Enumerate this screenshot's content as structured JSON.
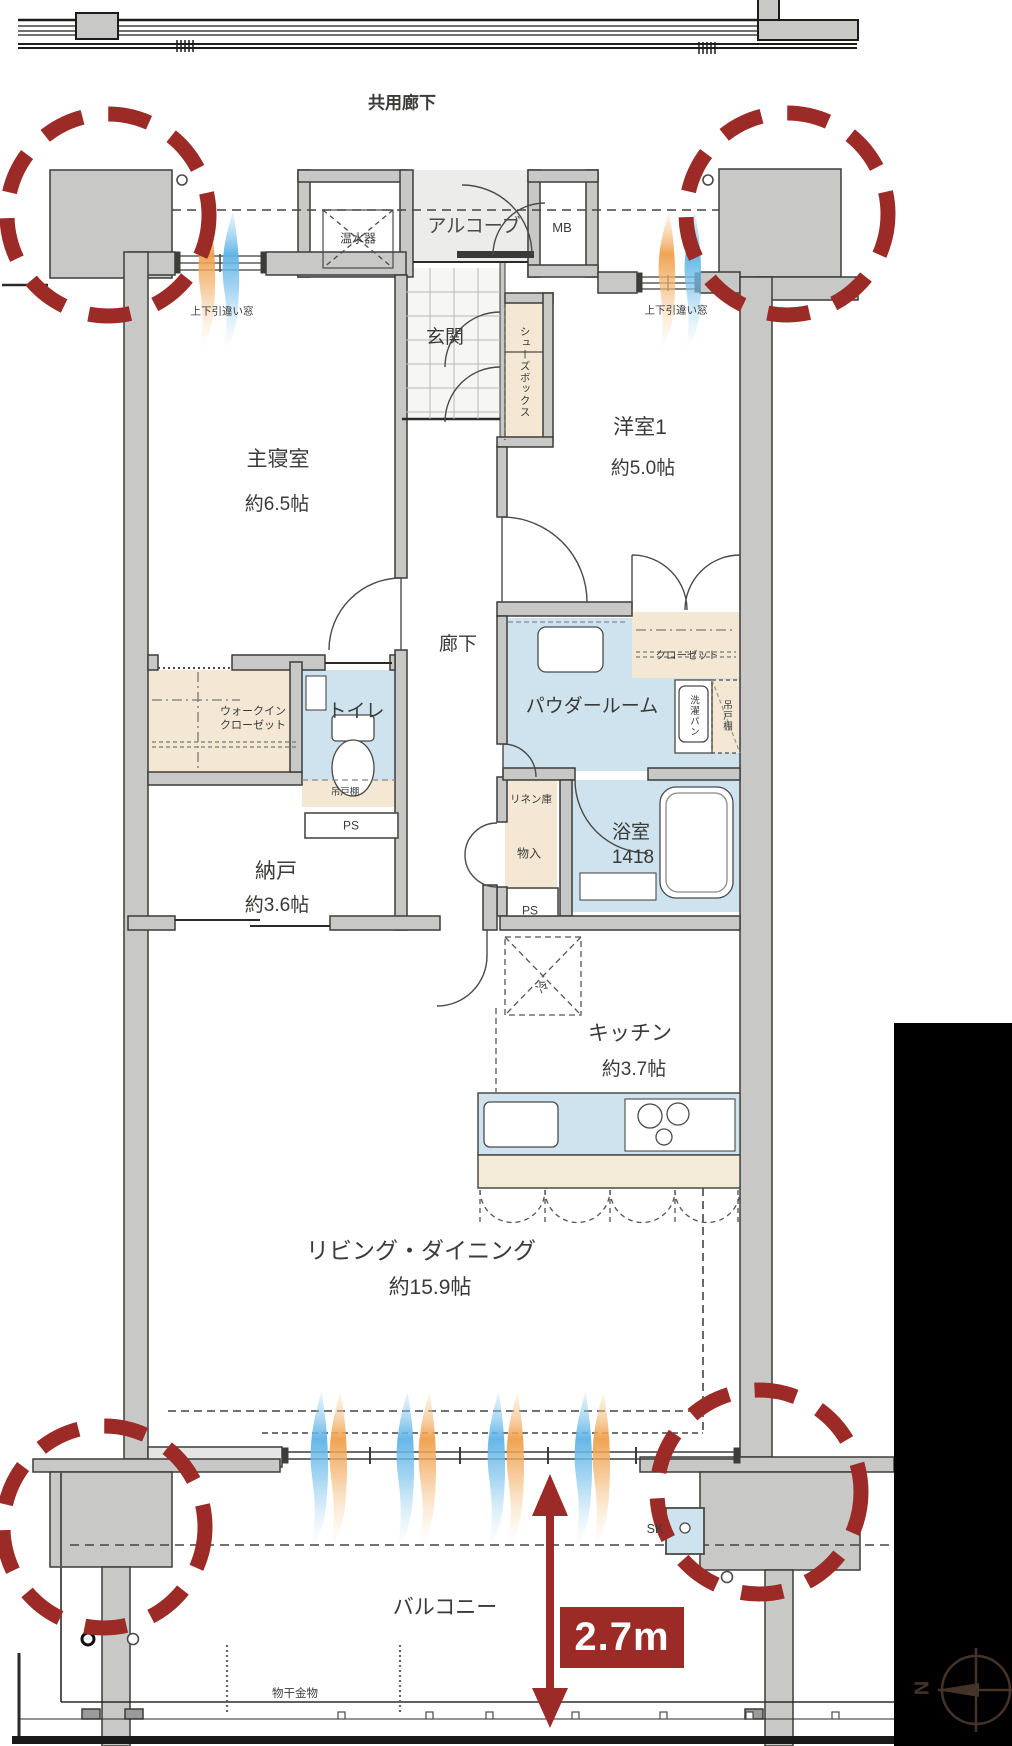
{
  "colors": {
    "highlight_red": "#9c2b27",
    "wall_gray": "#c8c8c6",
    "floor_light": "#ececea",
    "wet_blue": "#cfe3ef",
    "storage_beige": "#f4e8d4",
    "airflow_blue": "#5db3e6",
    "airflow_orange": "#ef9f4b",
    "mask_black": "#000000",
    "compass_brown": "#45332a"
  },
  "header": {
    "common_corridor": "共用廊下"
  },
  "rooms": {
    "master_bedroom": {
      "name": "主寝室",
      "area": "約6.5帖"
    },
    "western_room_1": {
      "name": "洋室1",
      "area": "約5.0帖"
    },
    "storage_room": {
      "name": "納戸",
      "area": "約3.6帖"
    },
    "kitchen": {
      "name": "キッチン",
      "area": "約3.7帖"
    },
    "living_dining": {
      "name": "リビング・ダイニング",
      "area": "約15.9帖"
    },
    "bathroom": {
      "name": "浴室",
      "size": "1418"
    },
    "powder_room": {
      "name": "パウダールーム"
    },
    "toilet": {
      "name": "トイレ"
    },
    "hallway": {
      "name": "廊下"
    },
    "entrance": {
      "name": "玄関"
    },
    "alcove": {
      "name": "アルコーブ"
    },
    "balcony": {
      "name": "バルコニー"
    }
  },
  "fixtures": {
    "water_heater": "温水器",
    "meter_box": "MB",
    "shoes_box": "シューズボックス",
    "walk_in_closet_line1": "ウォークイン",
    "walk_in_closet_line2": "クローゼット",
    "closet": "クローゼット",
    "hanging_cupboard_toilet": "吊戸棚",
    "hanging_cupboard_powder": "吊戸棚",
    "washer_pan": "洗濯パン",
    "linen_cabinet": "リネン庫",
    "storage_in": "物入",
    "pipe_space_1": "PS",
    "pipe_space_2": "PS",
    "refrigerator": "冷",
    "slop_sink": "SK",
    "laundry_hardware": "物干金物"
  },
  "annotations": {
    "window_top_left": "上下引違い窓",
    "window_top_right": "上下引違い窓",
    "balcony_depth": "2.7m",
    "compass_north": "N"
  }
}
